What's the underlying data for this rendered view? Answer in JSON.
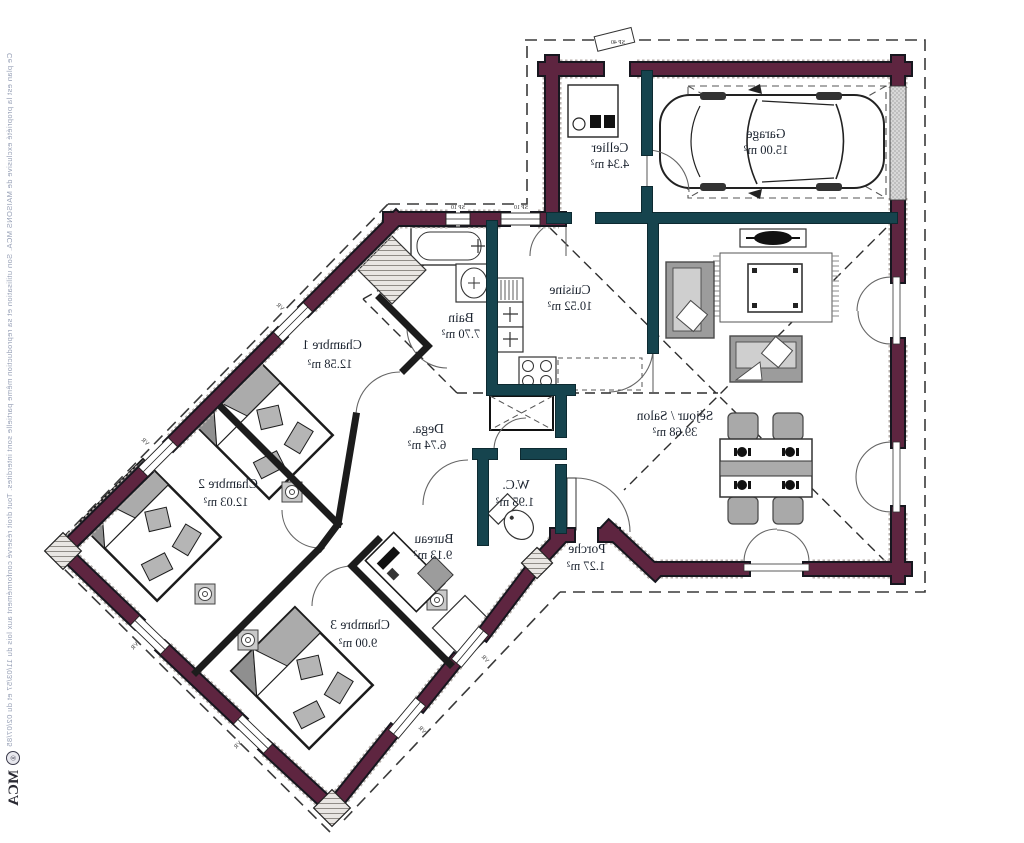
{
  "title": "Plan de maison (miroir) - MAISONS MCA",
  "rooms": [
    {
      "name": "Garage",
      "area": "15.00 m²"
    },
    {
      "name": "Cellier",
      "area": "4.34 m²"
    },
    {
      "name": "Cuisine",
      "area": "10.52 m²"
    },
    {
      "name": "Bain",
      "area": "7.70 m²"
    },
    {
      "name": "Séjour / Salon",
      "area": "39.68 m²"
    },
    {
      "name": "Chambre 1",
      "area": "12.58 m²"
    },
    {
      "name": "Chambre 2",
      "area": "12.03 m²"
    },
    {
      "name": "Chambre 3",
      "area": "9.00 m²"
    },
    {
      "name": "Bureau",
      "area": "9.13 m²"
    },
    {
      "name": "Dega.",
      "area": "6.74 m²"
    },
    {
      "name": "W.C.",
      "area": "1.95 m²"
    },
    {
      "name": "Porche",
      "area": "1.27 m²"
    }
  ],
  "window_labels": {
    "sp10": "SP 10",
    "sp40": "SP 40",
    "vr": "VR"
  },
  "branding": {
    "copyright": "Ce plan est la propriété exclusive de MAISONS MCA. Son utilisation et sa reproduction même partielle sont interdites. Tout droit réservé conformément aux lois du 11/03/57 et du 02/07/85",
    "logo_symbol": "®",
    "logo_text": "MCA"
  },
  "colors": {
    "exterior_wall": "#5e2540",
    "interior_wall": "#16444e",
    "partition_wall": "#1c1c1c",
    "furniture_gray": "#9c9c9c"
  }
}
